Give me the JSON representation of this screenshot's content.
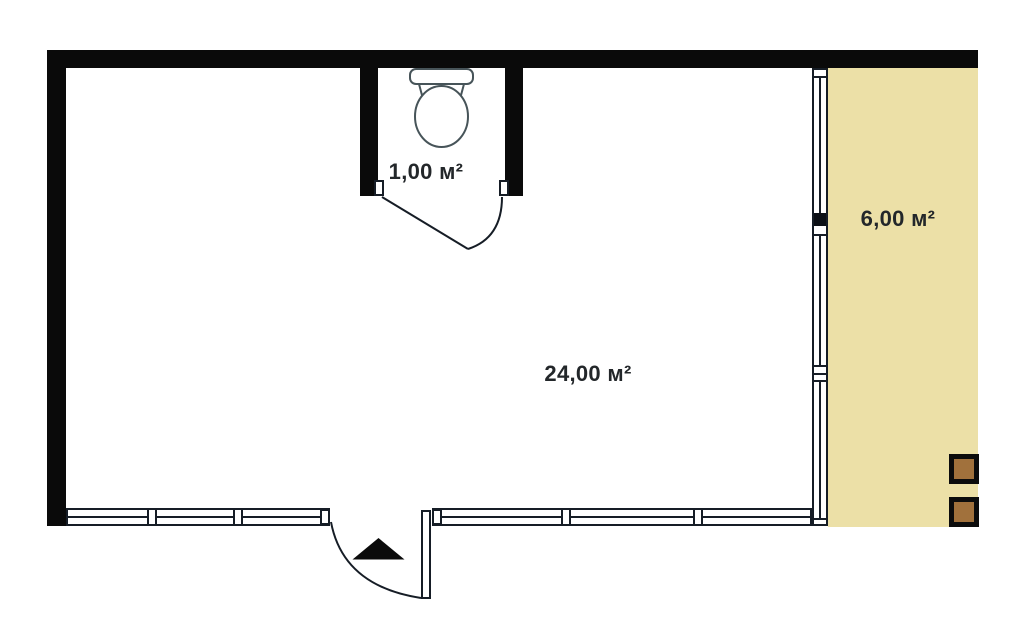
{
  "floor_plan": {
    "rooms": {
      "main": {
        "area_label": "24,00 м²"
      },
      "bathroom": {
        "area_label": "1,00 м²"
      },
      "terrace": {
        "area_label": "6,00 м²"
      }
    },
    "icons": [
      "toilet-icon",
      "entrance-arrow-icon",
      "door-swing-arc",
      "window-mullion",
      "terrace-post"
    ],
    "colors": {
      "wall": "#0a0a0a",
      "window_line": "#161d26",
      "terrace_fill": "#ece0a7",
      "post_fill": "#a1713c",
      "label_text": "#23272a",
      "toilet_line": "#475459",
      "background": "#ffffff"
    }
  }
}
